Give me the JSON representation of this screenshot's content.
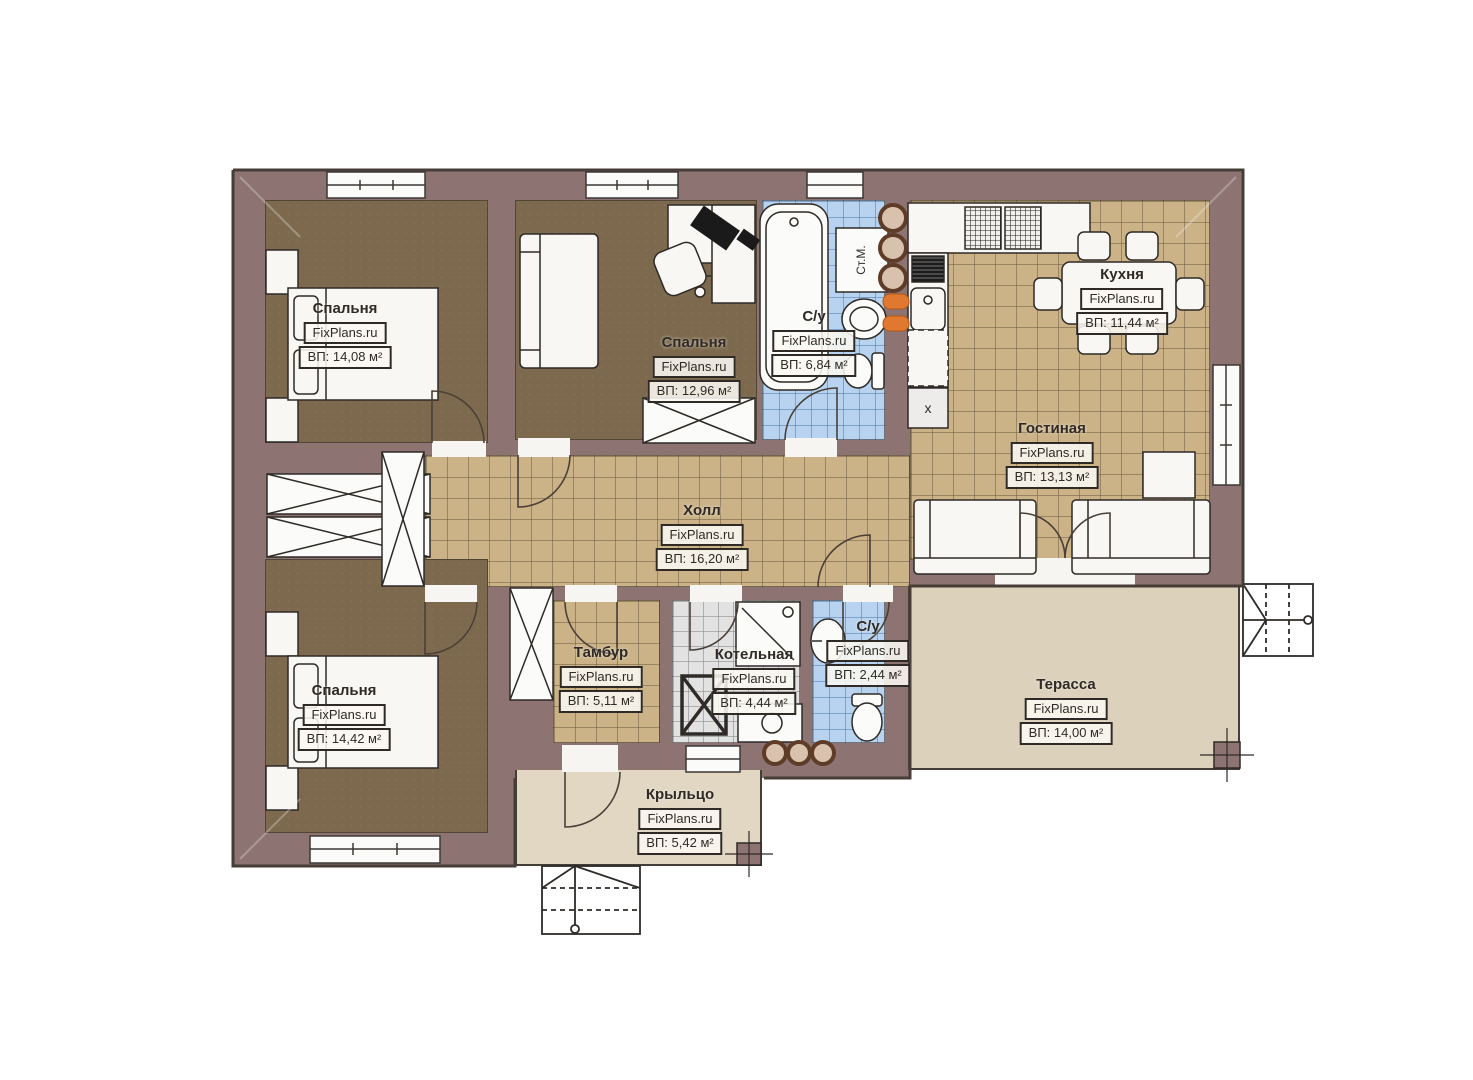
{
  "meta": {
    "watermark": "FixPlans.ru",
    "plan_type": "floor-plan"
  },
  "rooms": [
    {
      "id": "bedroom-1",
      "name": "Спальня",
      "area": "ВП: 14,08 м²"
    },
    {
      "id": "bedroom-2",
      "name": "Спальня",
      "area": "ВП: 12,96 м²"
    },
    {
      "id": "bathroom-1",
      "name": "С/у",
      "area": "ВП: 6,84 м²"
    },
    {
      "id": "kitchen",
      "name": "Кухня",
      "area": "ВП: 11,44 м²"
    },
    {
      "id": "living-room",
      "name": "Гостиная",
      "area": "ВП: 13,13 м²"
    },
    {
      "id": "hall",
      "name": "Холл",
      "area": "ВП: 16,20 м²"
    },
    {
      "id": "bedroom-3",
      "name": "Спальня",
      "area": "ВП: 14,42 м²"
    },
    {
      "id": "vestibule",
      "name": "Тамбур",
      "area": "ВП: 5,11 м²"
    },
    {
      "id": "boiler-room",
      "name": "Котельная",
      "area": "ВП: 4,44 м²"
    },
    {
      "id": "bathroom-2",
      "name": "С/у",
      "area": "ВП: 2,44 м²"
    },
    {
      "id": "terrace",
      "name": "Терасса",
      "area": "ВП: 14,00 м²"
    },
    {
      "id": "porch",
      "name": "Крыльцо",
      "area": "ВП: 5,42 м²"
    }
  ],
  "appliances": {
    "washing_machine": "Ст.М.",
    "cabinet_mark": "х"
  },
  "colors": {
    "wall": "#8d7472",
    "outline": "#463d37",
    "bedroom_floor": "#7d6a4e",
    "tile_floor": "#cbb287",
    "bath_tile": "#b7d3ef",
    "boiler_tile": "#e2e2e2",
    "terrace_deck": "#dcd1bb",
    "porch_deck": "#e1d7c3",
    "accent_orange": "#e0792f"
  }
}
